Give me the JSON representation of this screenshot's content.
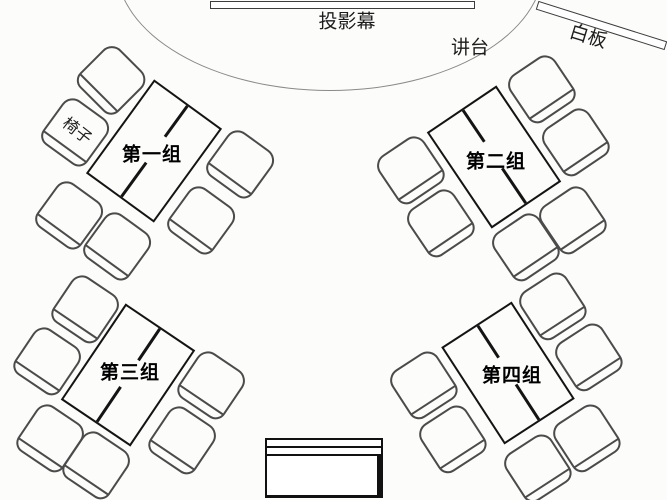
{
  "scene": {
    "screen_label": "投影幕",
    "lectern_label": "讲台",
    "whiteboard_label": "白板",
    "chair_label": "椅子"
  },
  "groups": [
    {
      "id": 1,
      "label": "第一组",
      "chair_count": 6
    },
    {
      "id": 2,
      "label": "第二组",
      "chair_count": 6
    },
    {
      "id": 3,
      "label": "第三组",
      "chair_count": 6
    },
    {
      "id": 4,
      "label": "第四组",
      "chair_count": 6
    }
  ]
}
